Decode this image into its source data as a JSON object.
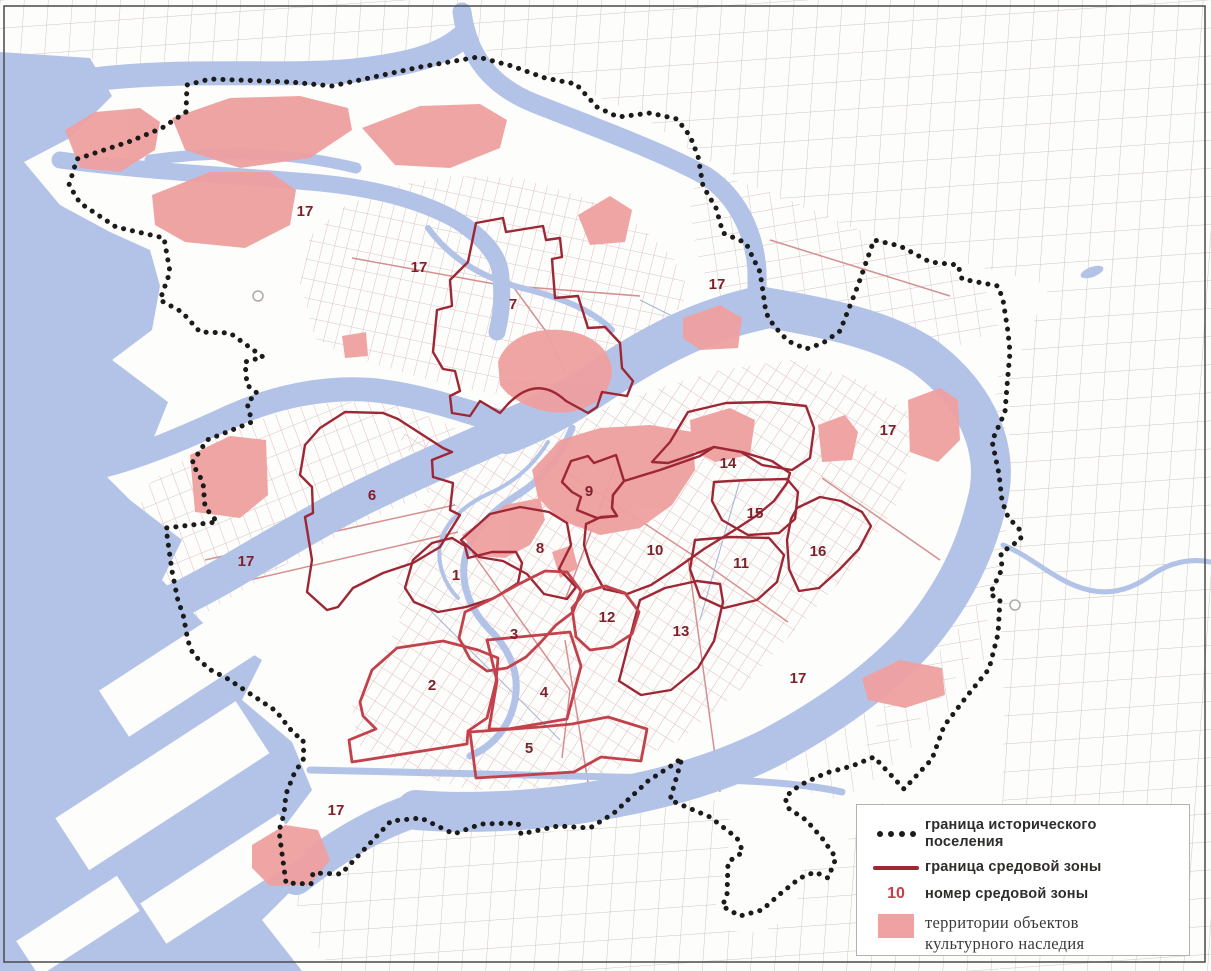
{
  "zones": {
    "z1": "1",
    "z2": "2",
    "z3": "3",
    "z4": "4",
    "z5": "5",
    "z6": "6",
    "z7": "7",
    "z8": "8",
    "z9": "9",
    "z10": "10",
    "z11": "11",
    "z12": "12",
    "z13": "13",
    "z14": "14",
    "z15": "15",
    "z16": "16",
    "z17": "17"
  },
  "legend": {
    "zone_number_sample": "10",
    "items": [
      {
        "id": "settlement-boundary",
        "symbol": "black-dotted-line",
        "label": "граница исторического поселения"
      },
      {
        "id": "zone-boundary",
        "symbol": "dark-red-line",
        "label": "граница средовой зоны"
      },
      {
        "id": "zone-number",
        "symbol": "red-number-10",
        "label": "номер средовой зоны"
      },
      {
        "id": "heritage-territories",
        "symbol": "pink-square",
        "label": "территории объектов культурного наследия"
      }
    ]
  },
  "colors": {
    "water": "#b3c3e8",
    "heritage": "#efa0a0",
    "zone_border": "#9e2736",
    "zone_border_bright": "#c2414b",
    "zone_number": "#7e1f2a",
    "settlement_boundary": "#1b1b1b",
    "street_pink": "#dcbcbc",
    "street_gray": "#cfc6c0"
  }
}
